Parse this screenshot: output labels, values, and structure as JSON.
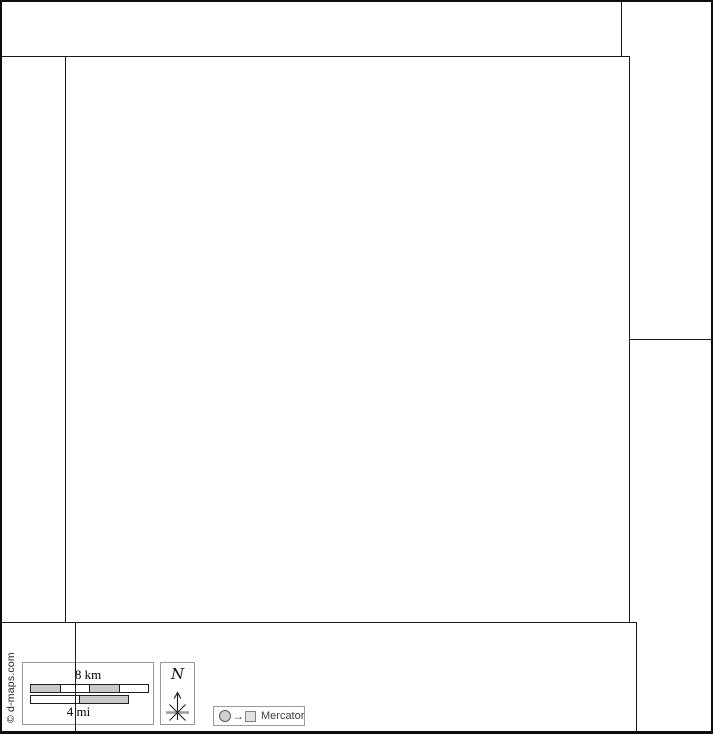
{
  "attribution": "© d-maps.com",
  "scale_box": {
    "km_label": "8 km",
    "mi_label": "4 mi",
    "km_segments": [
      "gray",
      "white",
      "gray",
      "white"
    ],
    "mi_segments": [
      "white",
      "gray"
    ]
  },
  "compass": {
    "north_label": "N"
  },
  "projection": {
    "arrow_glyph": "→",
    "label": "Mercator"
  },
  "colors": {
    "boundary": "#1a1a1a",
    "outer_frame": "#0d0d0d",
    "legend_border": "#999999",
    "bar_gray": "#c9c9c9",
    "bar_white": "#ffffff",
    "mercator_text": "#3f3f3f"
  }
}
